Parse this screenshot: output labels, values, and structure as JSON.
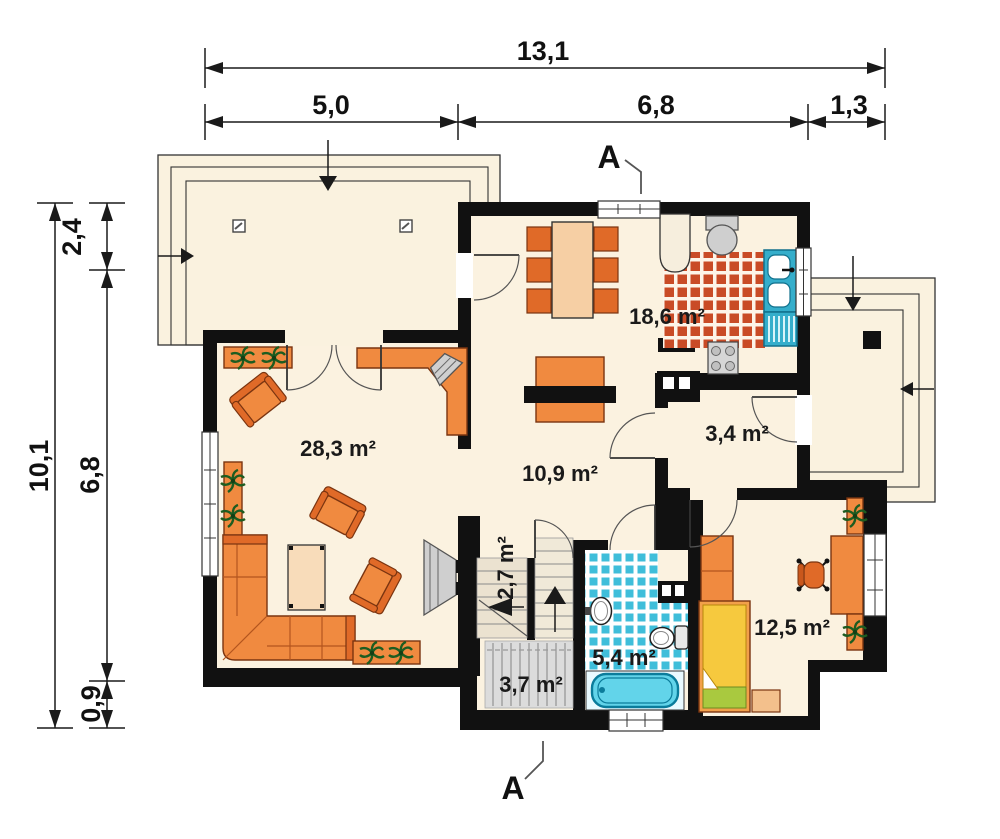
{
  "dimensions": {
    "top": {
      "total": "13,1",
      "segments": [
        "5,0",
        "6,8",
        "1,3"
      ]
    },
    "left": {
      "total": "10,1",
      "segments": [
        "2,4",
        "6,8",
        "0,9"
      ]
    }
  },
  "section": {
    "label": "A"
  },
  "rooms": {
    "living": "28,3 m²",
    "hall": "10,9 m²",
    "kitchen": "18,6 m²",
    "wc": "3,4 m²",
    "stairs": "2,7 m²",
    "vestibule": "3,7 m²",
    "bathroom": "5,4 m²",
    "bedroom": "12,5 m²"
  },
  "colors": {
    "wall": "#111111",
    "floor": "#fbf2e0",
    "furniture_orange": "#f08a40",
    "kitchen_tile": "#c94b26",
    "bathroom_tile": "#3fbeda",
    "bathtub": "#62d4ea",
    "bed_yellow": "#f6c93e",
    "pillow_green": "#a9c93f",
    "stairs_beige": "#ebe2d0",
    "mat_gray": "#dcdcdc"
  }
}
